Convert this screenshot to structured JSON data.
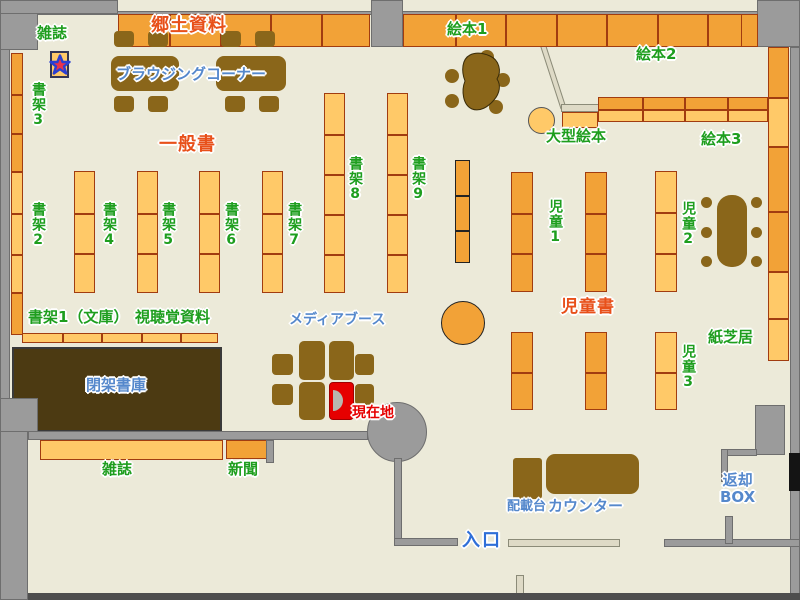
{
  "map_title": "library-floor-map",
  "labels": {
    "magazines_top": "雑誌",
    "local_materials": "郷土資料",
    "browsing_corner": "ブラウジングコーナー",
    "shelf_3": "書架3",
    "general_books": "一般書",
    "shelf_2": "書架2",
    "shelf_4": "書架4",
    "shelf_5": "書架5",
    "shelf_6": "書架6",
    "shelf_7": "書架7",
    "shelf_8": "書架8",
    "shelf_9": "書架9",
    "picture_books_1": "絵本1",
    "picture_books_2": "絵本2",
    "picture_books_3": "絵本3",
    "large_picture_books": "大型絵本",
    "children_1": "児童1",
    "children_2": "児童2",
    "children_3": "児童3",
    "children_books": "児童書",
    "kamishibai": "紙芝居",
    "shelf_1_bunko": "書架1（文庫）",
    "audiovisual": "視聴覚資料",
    "media_booth": "メディアブース",
    "current_location": "現在地",
    "closed_stacks": "閉架書庫",
    "magazines_bottom": "雑誌",
    "newspapers": "新聞",
    "loading_table": "配載台",
    "counter": "カウンター",
    "return_box_line1": "返却",
    "return_box_line2": "BOX",
    "entrance": "入口"
  },
  "icons": {
    "magazine_marker": "star-icon"
  },
  "colors": {
    "floor": "#ecead9",
    "wall_gray": "#9b9b9b",
    "shelf_light": "#ffc968",
    "shelf_dark": "#f2a237",
    "shelf_border": "#a13c10",
    "furniture_brown": "#8a661a",
    "closed_stacks_brown": "#4c3a12",
    "label_green": "#1e9e1e",
    "label_red_orange": "#e8501a",
    "label_blue": "#5588cc",
    "current_location_red": "#e60000",
    "star_red": "#e8334a",
    "star_blue_outline": "#2b3fd0"
  }
}
